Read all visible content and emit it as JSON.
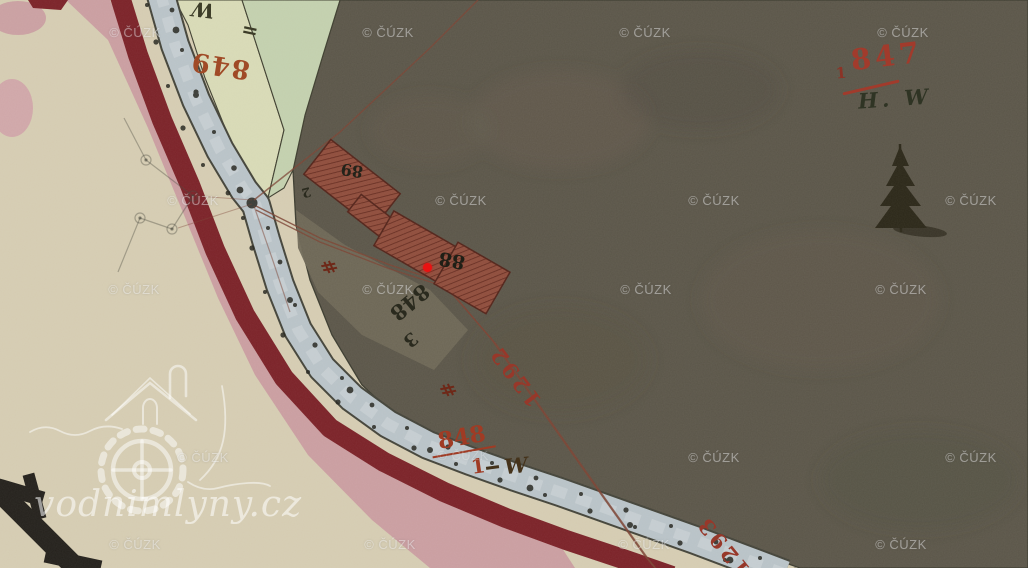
{
  "map": {
    "description": "Historical cadastral map tile (stable cadastre) with watermarks",
    "watermark_text": "© ČÚZK",
    "logo_text": "vodnimlyny.cz",
    "labels": {
      "usage_top": "W",
      "parcel_849": "849",
      "tick_marker": "=",
      "house_upper": "89",
      "house_lower": "88",
      "corner_2": "2",
      "parcel_848_3_num": "848",
      "parcel_848_3_sub": "3",
      "hash_marker_a": "#",
      "hash_marker_b": "#",
      "road_1292": "1292",
      "parcel_848_1_num": "848",
      "parcel_848_1_sub": "1",
      "usage_848_1": "W",
      "road_1293": "1293",
      "parcel_847": "847",
      "parcel_847_sub": "1",
      "usage_847": "H. W"
    },
    "colors": {
      "paper": "#d5ccb2",
      "forest": "#5b5649",
      "meadow_green": "#c3d0ae",
      "pale_green": "#d8dab6",
      "river_pink": "#c99ba0",
      "band_maroon": "#7b2228",
      "road_fill": "#b9c3c8",
      "building_red": "#8a4a3c",
      "ink_red": "#97382a",
      "ink_black": "#2a2a1e",
      "highlight_point": "#e91212"
    }
  }
}
